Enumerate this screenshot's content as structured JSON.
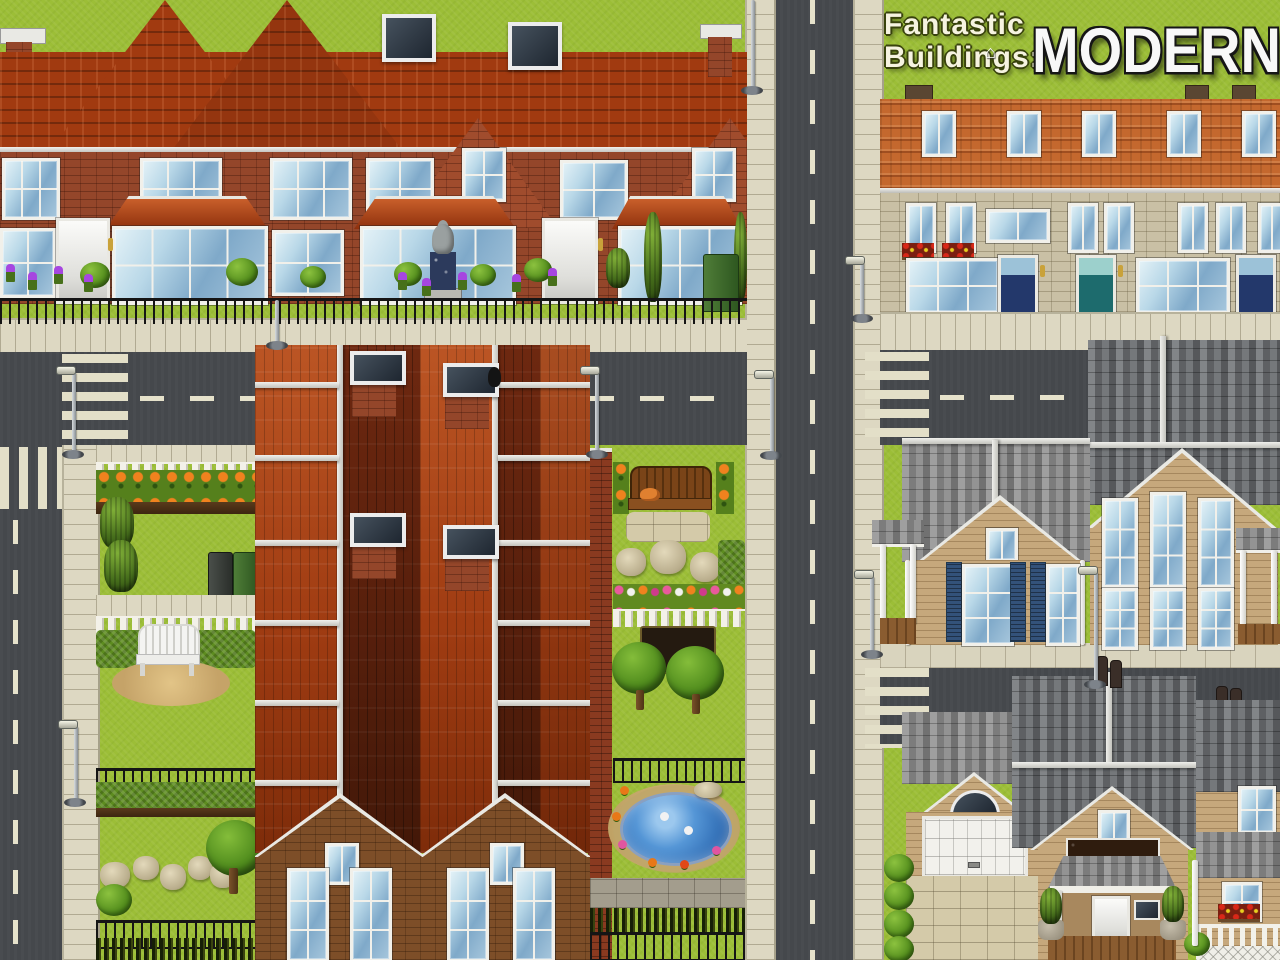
{
  "title": {
    "prefix_line1": "Fantastic",
    "prefix_line2": "Buildings:",
    "main": "MODERN",
    "house_glyph": "⌂"
  },
  "palette": {
    "grass": "#9cbe37",
    "asphalt": "#45484c",
    "road_marking": "#e6e2cb",
    "sidewalk": "#ddd8c2",
    "red_roof": "#a13a10",
    "clay_roof": "#c4682e",
    "brick_wall": "#94462a",
    "apartment_brick": "#7d4e28",
    "stone_wall": "#c9c0a5",
    "gray_shingle": "#8d8d8d",
    "tan_siding": "#c6a87c",
    "door_navy": "#23386b",
    "door_teal": "#1d6b6d",
    "shutter_blue": "#33527a",
    "pond_water": "#3f80c8",
    "picket_fence": "#f3f1e9",
    "iron_fence": "#151515"
  },
  "scene": {
    "style": "pixel-art town map preview",
    "sections": [
      {
        "name": "brick-terraced-houses",
        "position": "top-left"
      },
      {
        "name": "large-apartment-block",
        "position": "center"
      },
      {
        "name": "stone-terraced-houses",
        "position": "top-right"
      },
      {
        "name": "suburban-houses",
        "position": "middle-right"
      },
      {
        "name": "garage-house-and-porch-house",
        "position": "bottom-right"
      },
      {
        "name": "gardens-with-benches-and-pond",
        "position": "center-left-and-right"
      },
      {
        "name": "road-grid-with-crosswalks-and-lamps",
        "position": "throughout"
      }
    ]
  }
}
